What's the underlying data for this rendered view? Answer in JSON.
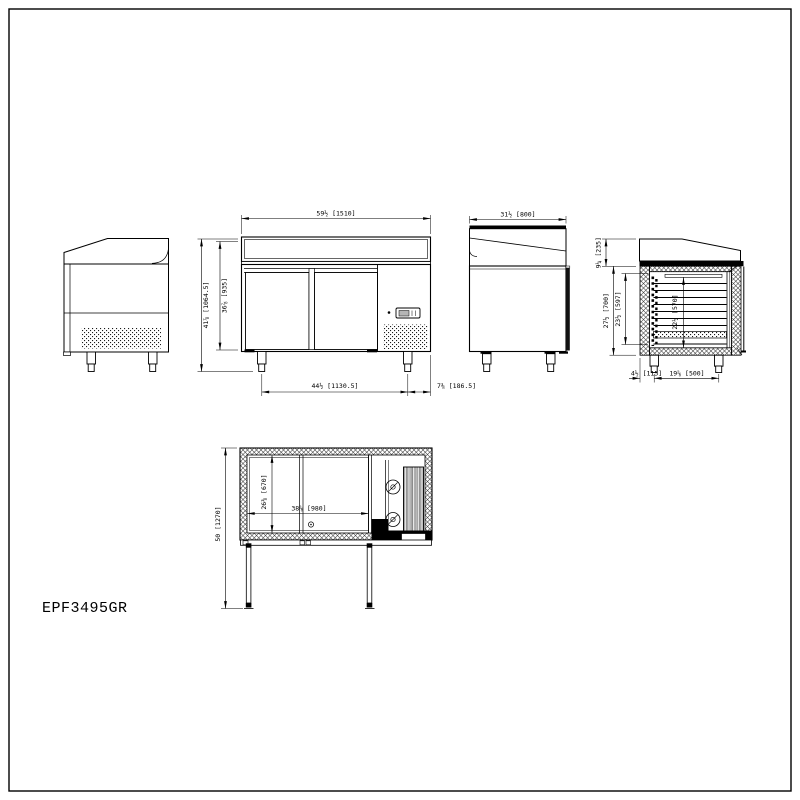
{
  "page": {
    "background": "#ffffff",
    "line_color": "#000000"
  },
  "title_block": {
    "model": "EPF3495GR"
  },
  "views": {
    "front": {
      "width_dim": "59½ [1510]",
      "overall_height_dim": "41⅞ [1064.5]",
      "body_height_dim": "36⅞ [935]",
      "leg_span_dim": "44½ [1130.5]",
      "leg_to_edge_dim": "7⅜ [186.5]"
    },
    "side": {
      "depth_dim": "31½ [800]"
    },
    "section": {
      "hood_height_dim": "9¼ [235]",
      "body_height_dim": "27½ [700]",
      "interior_height_dim": "23½ [597]",
      "interior_depth_dim": "22½ [570]",
      "leg_inset_dim": "4½ [115]",
      "leg_spacing_dim": "19⅝ [500]"
    },
    "plan": {
      "depth_doors_open_dim": "50 [1270]",
      "interior_depth_dim": "26⅜ [670]",
      "interior_width_dim": "38⅝ [980]"
    }
  }
}
